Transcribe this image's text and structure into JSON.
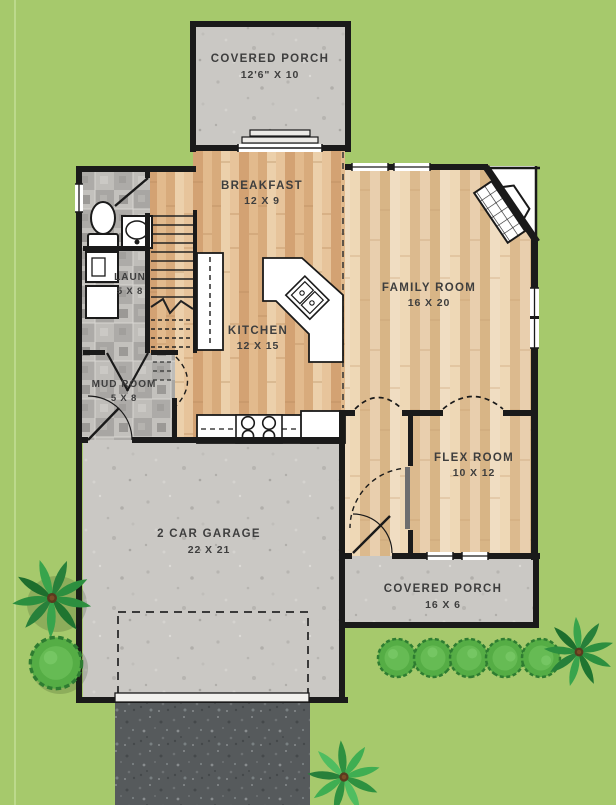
{
  "plan": {
    "rooms": {
      "covered_porch_top": {
        "label": "COVERED PORCH",
        "dims": "12'6\" X 10"
      },
      "breakfast": {
        "label": "BREAKFAST",
        "dims": "12 X 9"
      },
      "family_room": {
        "label": "FAMILY ROOM",
        "dims": "16 X 20"
      },
      "kitchen": {
        "label": "KITCHEN",
        "dims": "12 X 15"
      },
      "laundry": {
        "label": "LAUN",
        "dims": "5 X 8"
      },
      "mud_room": {
        "label": "MUD ROOM",
        "dims": "5 X 8"
      },
      "flex_room": {
        "label": "FLEX ROOM",
        "dims": "10 X 12"
      },
      "garage": {
        "label": "2 CAR GARAGE",
        "dims": "22 X 21"
      },
      "covered_porch_bottom": {
        "label": "COVERED PORCH",
        "dims": "16 X 6"
      }
    },
    "colors": {
      "grass": "#a6c96c",
      "concrete": "#cac8c4",
      "asphalt": "#565a5c",
      "wall": "#1a1a1a",
      "wood": "#ddb083",
      "wood_light": "#e6c9a1",
      "tile": "#b2b0ad",
      "label_text": "#3e3e3e",
      "shrub": "#2c8f3f",
      "bush": "#55ad45"
    }
  }
}
